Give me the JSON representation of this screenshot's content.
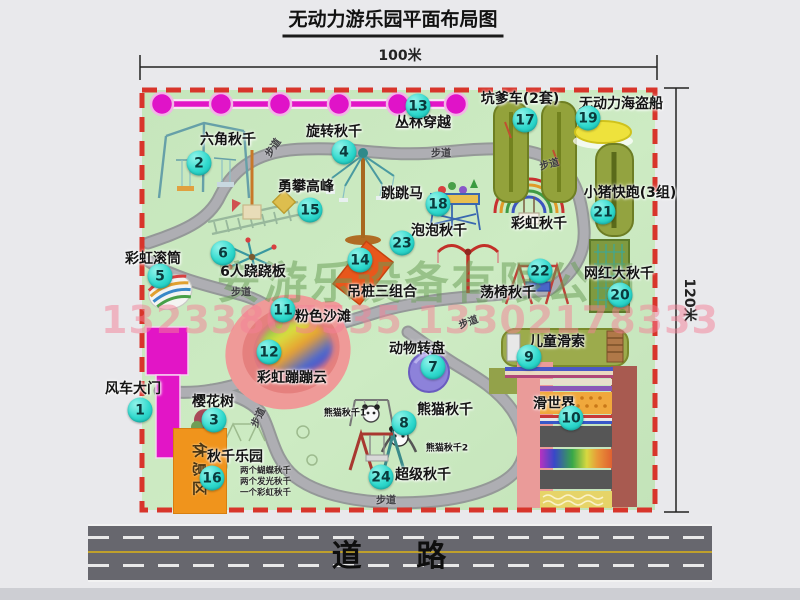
{
  "title": "无动力游乐园平面布局图",
  "dimensions": {
    "width_label": "100米",
    "height_label": "120米"
  },
  "road": {
    "label": "道 路"
  },
  "watermark": {
    "company": "安游乐设备有限公司",
    "phone": "13233805535 13302178333"
  },
  "path_label": "步道",
  "rest_area_label": "休息区",
  "attractions": [
    {
      "num": "1",
      "name": "风车大门"
    },
    {
      "num": "2",
      "name": "六角秋千"
    },
    {
      "num": "3",
      "name": "樱花树"
    },
    {
      "num": "4",
      "name": "旋转秋千"
    },
    {
      "num": "5",
      "name": "彩虹滚筒"
    },
    {
      "num": "6",
      "name": "6人跷跷板"
    },
    {
      "num": "7",
      "name": "动物转盘"
    },
    {
      "num": "8",
      "name": "熊猫秋千"
    },
    {
      "num": "9",
      "name": "儿童滑索"
    },
    {
      "num": "10",
      "name": "滑世界"
    },
    {
      "num": "11",
      "name": "粉色沙滩"
    },
    {
      "num": "12",
      "name": "彩虹蹦蹦云"
    },
    {
      "num": "13",
      "name": "丛林穿越"
    },
    {
      "num": "14",
      "name": "吊桩三组合"
    },
    {
      "num": "15",
      "name": "勇攀高峰"
    },
    {
      "num": "16",
      "name": "秋千乐园",
      "notes": [
        "两个蝴蝶秋千",
        "两个发光秋千",
        "一个彩虹秋千"
      ]
    },
    {
      "num": "17",
      "name": "坑爹车(2套)"
    },
    {
      "num": "18",
      "name": "跳跳马"
    },
    {
      "num": "19",
      "name": "无动力海盗船"
    },
    {
      "num": "20",
      "name": "网红大秋千"
    },
    {
      "num": "21",
      "name": "小猪快跑(3组)"
    },
    {
      "num": "22",
      "name": "荡椅秋千"
    },
    {
      "num": "23",
      "name": "泡泡秋千"
    },
    {
      "num": "24",
      "name": "超级秋千"
    }
  ],
  "unnumbered": {
    "rainbow_swing": "彩虹秋千",
    "panda_swing_1": "熊猫秋千1",
    "panda_swing_2": "熊猫秋千2"
  },
  "colors": {
    "park_green": "#c9e8c0",
    "border_red": "#d8352b",
    "magenta": "#e215c6",
    "badge_cyan": "#2fd9cd",
    "road_gray": "#67676e",
    "rest_orange": "#f0941c"
  }
}
